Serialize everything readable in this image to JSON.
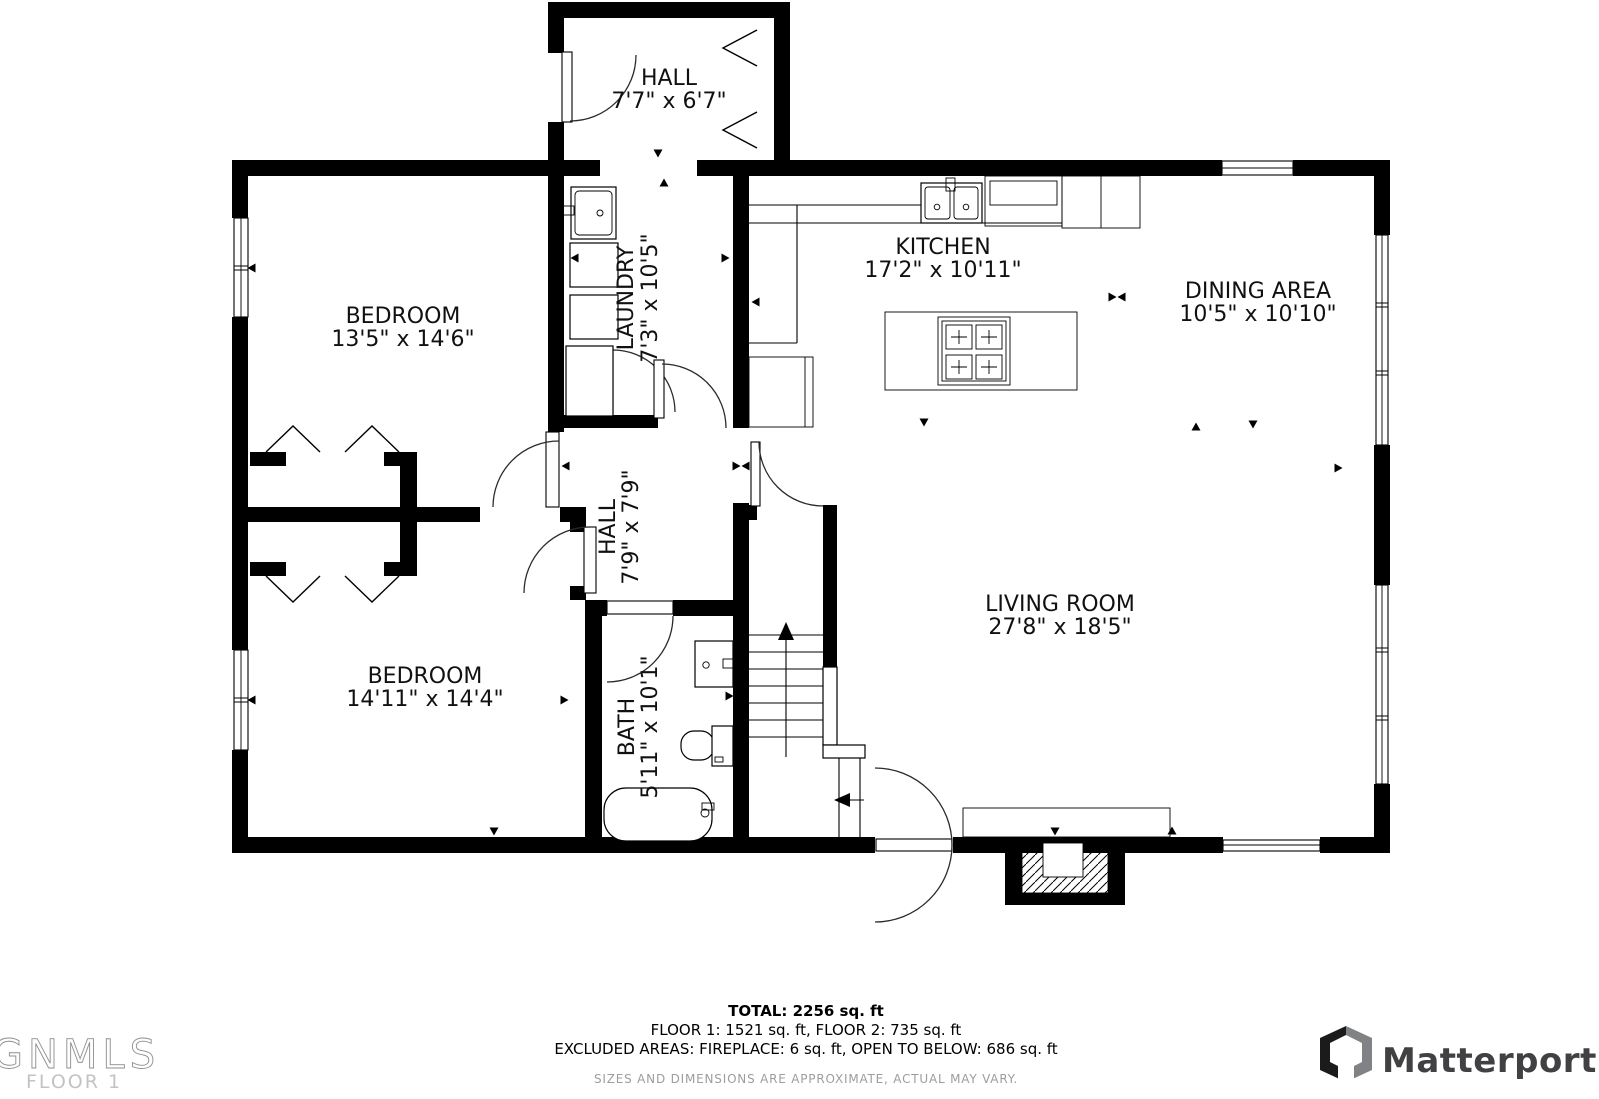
{
  "floor_plan": {
    "wall_color": "#000000",
    "rooms": {
      "hall_upper": {
        "name": "HALL",
        "dims": "7'7\" x 6'7\""
      },
      "bedroom_1": {
        "name": "BEDROOM",
        "dims": "13'5\" x 14'6\""
      },
      "laundry": {
        "name": "LAUNDRY",
        "dims": "7'3\" x 10'5\""
      },
      "kitchen": {
        "name": "KITCHEN",
        "dims": "17'2\" x 10'11\""
      },
      "dining": {
        "name": "DINING AREA",
        "dims": "10'5\" x 10'10\""
      },
      "hall_main": {
        "name": "HALL",
        "dims": "7'9\" x 7'9\""
      },
      "bedroom_2": {
        "name": "BEDROOM",
        "dims": "14'11\" x 14'4\""
      },
      "bath": {
        "name": "BATH",
        "dims": "5'11\" x 10'1\""
      },
      "living": {
        "name": "LIVING ROOM",
        "dims": "27'8\" x 18'5\""
      }
    }
  },
  "summary": {
    "total": "TOTAL: 2256 sq. ft",
    "floors": "FLOOR 1: 1521 sq. ft, FLOOR 2: 735 sq. ft",
    "excluded": "EXCLUDED AREAS: FIREPLACE: 6 sq. ft, OPEN TO BELOW: 686 sq. ft",
    "disclaimer": "SIZES AND DIMENSIONS ARE APPROXIMATE, ACTUAL MAY VARY."
  },
  "watermark": {
    "mls_name": "GNMLS",
    "floor_label": "FLOOR 1"
  },
  "branding": {
    "company": "Matterport"
  }
}
